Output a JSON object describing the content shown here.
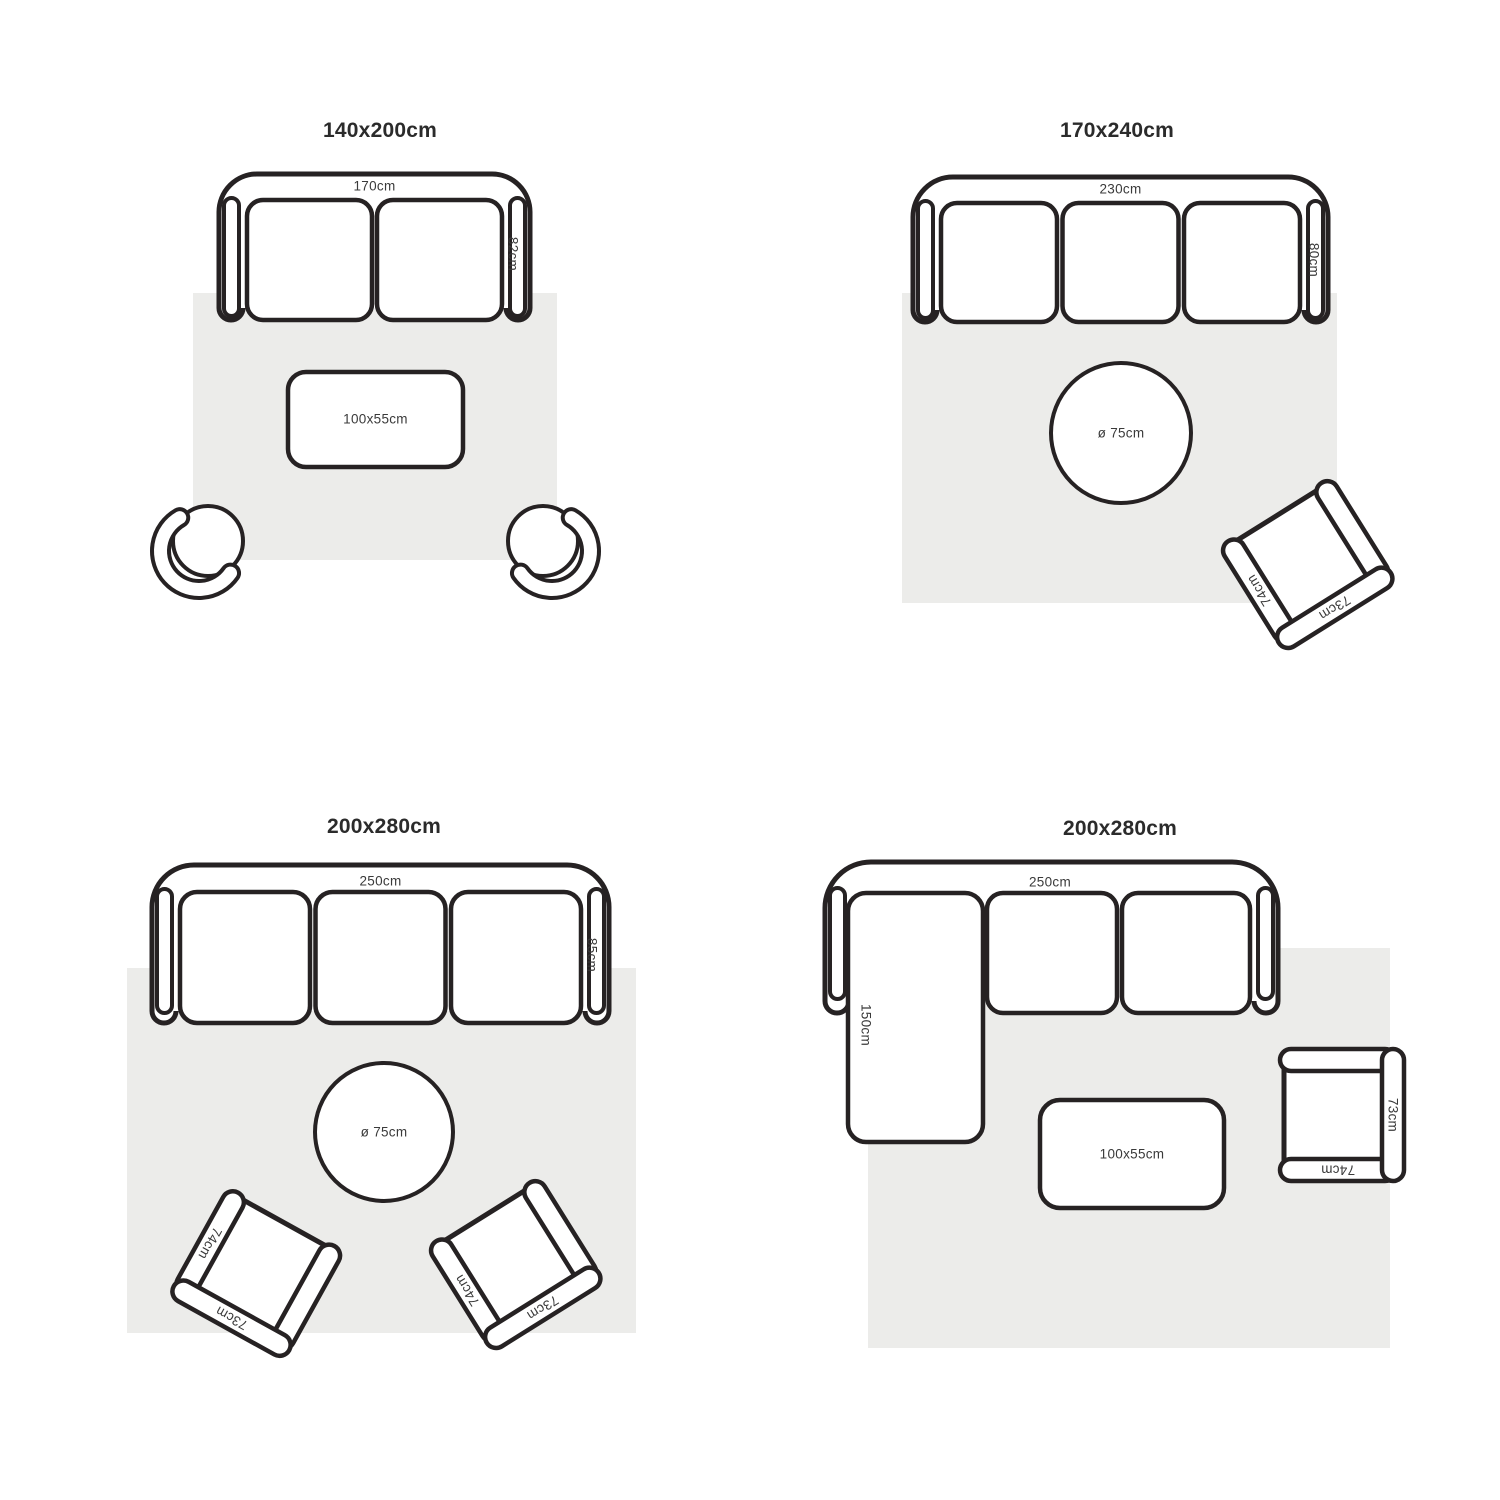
{
  "colors": {
    "outline": "#262223",
    "rug": "#ececea",
    "label": "#3a3a3a",
    "title": "#2b2b2b",
    "background": "#ffffff"
  },
  "quadrants": [
    {
      "title": "140x200cm",
      "sofa": {
        "type": "2-seat sofa",
        "width": "170cm",
        "depth": "82cm"
      },
      "coffee_table": {
        "size": "100x55cm"
      }
    },
    {
      "title": "170x240cm",
      "sofa": {
        "type": "3-seat sofa",
        "width": "230cm",
        "depth": "80cm"
      },
      "round_table": {
        "size": "ø 75cm"
      },
      "armchair": {
        "width": "74cm",
        "depth": "73cm"
      }
    },
    {
      "title": "200x280cm",
      "sofa": {
        "type": "3-seat sofa",
        "width": "250cm",
        "depth": "85cm"
      },
      "round_table": {
        "size": "ø 75cm"
      },
      "armchair_left": {
        "width": "74cm",
        "depth": "73cm"
      },
      "armchair_right": {
        "width": "74cm",
        "depth": "73cm"
      }
    },
    {
      "title": "200x280cm",
      "sofa": {
        "type": "chaise sectional sofa",
        "width": "250cm",
        "chaise": "150cm"
      },
      "coffee_table": {
        "size": "100x55cm"
      },
      "armchair": {
        "width": "74cm",
        "depth": "73cm"
      }
    }
  ]
}
